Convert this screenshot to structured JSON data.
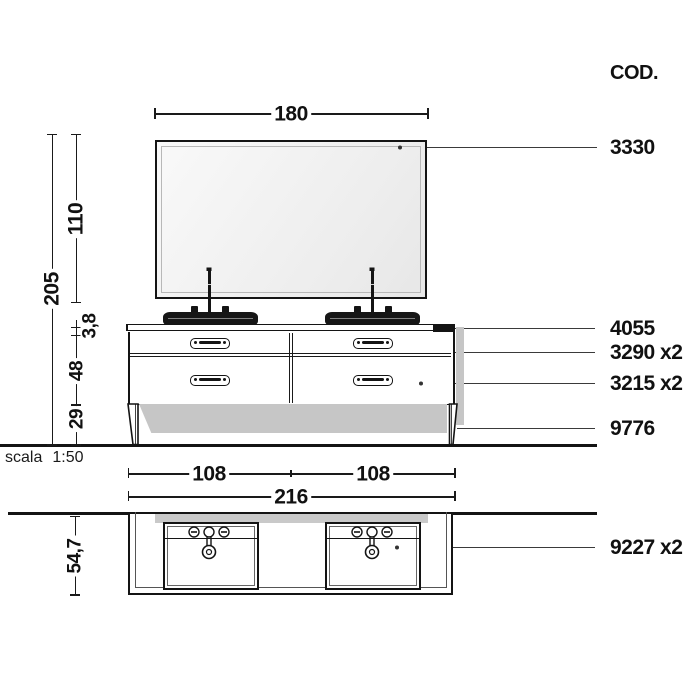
{
  "cod": {
    "header": "COD."
  },
  "codes": [
    {
      "label": "3330",
      "target": "mirror"
    },
    {
      "label": "4055",
      "target": "countertop"
    },
    {
      "label": "3290 x2",
      "target": "upper-drawer"
    },
    {
      "label": "3215 x2",
      "target": "lower-drawer"
    },
    {
      "label": "9776",
      "target": "leg"
    },
    {
      "label": "9227 x2",
      "target": "washbasin-plan"
    }
  ],
  "dimensions": {
    "mirror_width": "180",
    "total_height": "205",
    "mirror_height": "110",
    "countertop_thickness": "3,8",
    "cabinet_height": "48",
    "leg_height": "29",
    "left_basin_span": "108",
    "right_basin_span": "108",
    "total_width": "216",
    "depth": "54,7"
  },
  "scale": {
    "label": "scala",
    "value": "1:50"
  },
  "colors": {
    "line": "#141414",
    "shadow": "#c6c6c6",
    "mirror_fill": "#ededed",
    "plan_mirror_band": "#c9c9c9",
    "background": "#ffffff"
  }
}
